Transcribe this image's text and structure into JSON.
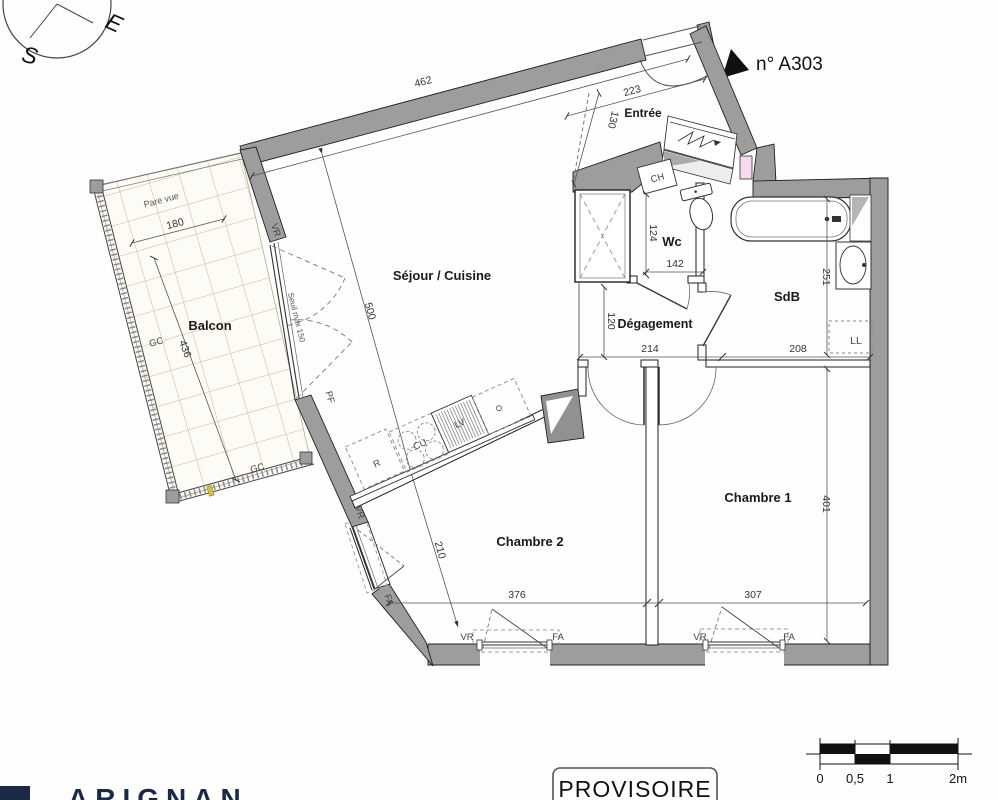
{
  "compass": {
    "east": "E",
    "south": "S"
  },
  "unit": {
    "number_label": "n° A303"
  },
  "rooms": {
    "entree": "Entrée",
    "wc": "Wc",
    "sdb": "SdB",
    "degagement": "Dégagement",
    "sejour": "Séjour / Cuisine",
    "balcon": "Balcon",
    "chambre1": "Chambre 1",
    "chambre2": "Chambre 2"
  },
  "dimensions": {
    "d462": "462",
    "d223": "223",
    "d130": "130",
    "d500": "500",
    "d210": "210",
    "d180": "180",
    "d436": "436",
    "d124": "124",
    "d142": "142",
    "d120": "120",
    "d214": "214",
    "d208": "208",
    "d251": "251",
    "d401": "401",
    "d376": "376",
    "d307": "307"
  },
  "annotations": {
    "pare_vue": "Pare vue",
    "seuil": "Seuil max 150",
    "gc": "GC",
    "vr": "VR",
    "fa": "FA",
    "pf": "PF",
    "ch": "CH",
    "ll": "LL",
    "cu": "CU",
    "lv": "LV",
    "r": "R"
  },
  "stamp": {
    "text": "PROVISOIRE"
  },
  "scale_bar": {
    "t0": "0",
    "t05": "0,5",
    "t1": "1",
    "t2": "2m"
  },
  "logo": {
    "partial_text": "ARIGNAN"
  },
  "colors": {
    "wall_gray": "#9d9d9d",
    "gaine_pink": "#f7d9f0",
    "balcony_grid_tan": "#c9b896",
    "logo_navy": "#1b2945"
  }
}
